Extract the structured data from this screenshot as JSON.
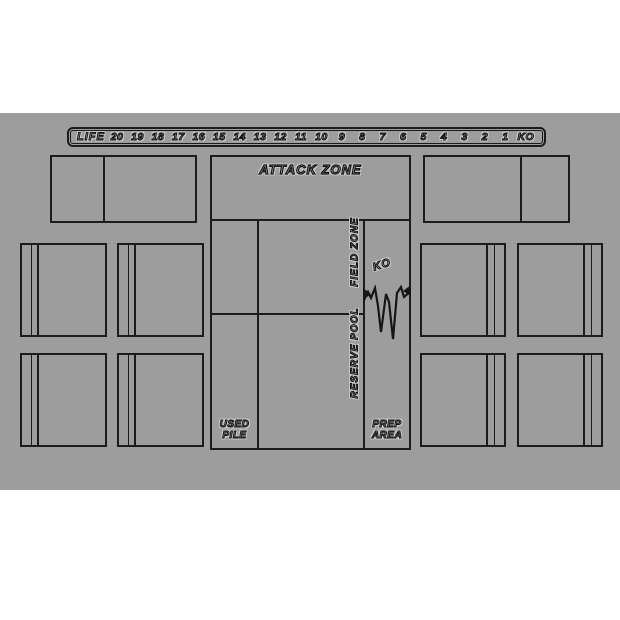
{
  "colors": {
    "page_background": "#ffffff",
    "mat_background": "#9d9d9d",
    "line": "#1c1c1c"
  },
  "life_track": {
    "label": "LIFE",
    "values": [
      "20",
      "19",
      "18",
      "17",
      "16",
      "15",
      "14",
      "13",
      "12",
      "11",
      "10",
      "9",
      "8",
      "7",
      "6",
      "5",
      "4",
      "3",
      "2",
      "1",
      "KO"
    ]
  },
  "zones": {
    "attack_zone_label": "ATTACK ZONE",
    "field_zone_label": "FIELD ZONE",
    "reserve_pool_label": "RESERVE POOL",
    "ko_label": "KO",
    "used_pile_line1": "USED",
    "used_pile_line2": "PILE",
    "prep_area_line1": "PREP",
    "prep_area_line2": "AREA"
  }
}
